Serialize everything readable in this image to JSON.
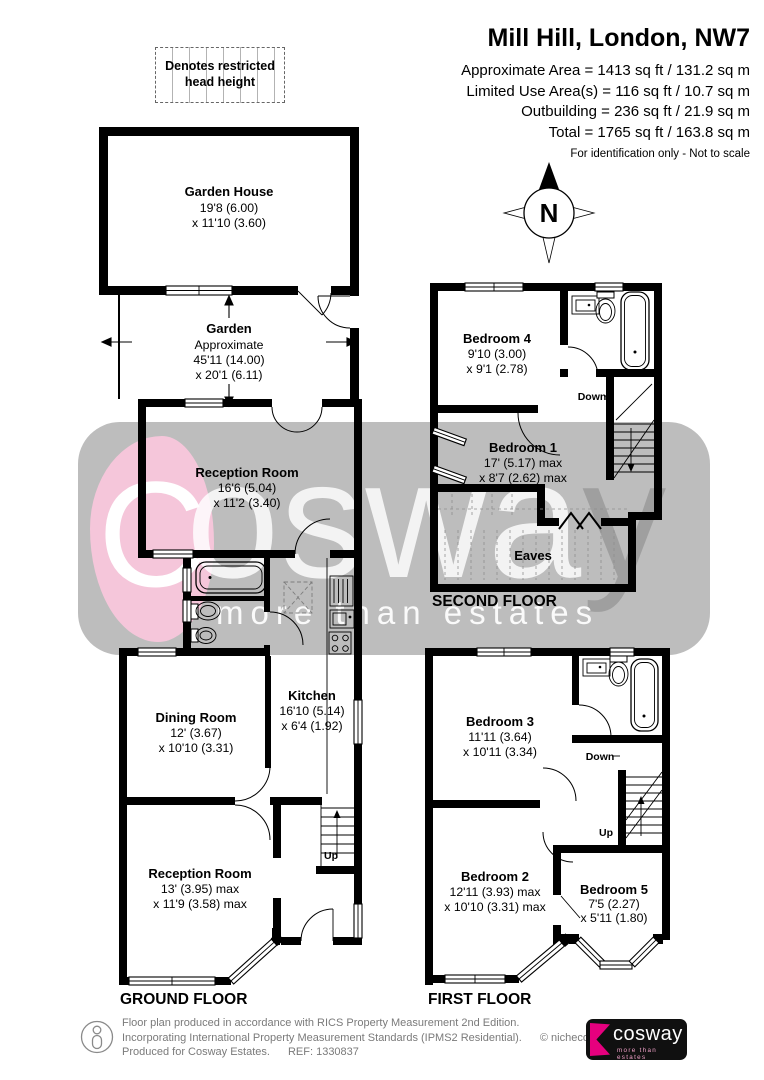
{
  "header": {
    "title": "Mill Hill, London, NW7",
    "line1": "Approximate Area = 1413 sq ft / 131.2 sq m",
    "line2": "Limited Use Area(s) = 116 sq ft / 10.7 sq m",
    "line3": "Outbuilding = 236 sq ft / 21.9 sq m",
    "line4": "Total = 1765 sq ft / 163.8 sq m",
    "disclaimer": "For identification only - Not to scale"
  },
  "legend": {
    "text": "Denotes restricted head height"
  },
  "compass": {
    "north": "N"
  },
  "watermark": {
    "initial": "C",
    "word_rest": "oswa",
    "word_last": "y",
    "tagline": "more than estates"
  },
  "floors": {
    "ground": {
      "label": "GROUND FLOOR",
      "stairs_up": "Up",
      "garden_house": {
        "name": "Garden House",
        "dim1": "19'8 (6.00)",
        "dim2": "x 11'10 (3.60)"
      },
      "garden": {
        "name": "Garden",
        "note": "Approximate",
        "dim1": "45'11 (14.00)",
        "dim2": "x 20'1 (6.11)"
      },
      "reception1": {
        "name": "Reception Room",
        "dim1": "16'6 (5.04)",
        "dim2": "x 11'2 (3.40)"
      },
      "kitchen": {
        "name": "Kitchen",
        "dim1": "16'10 (5.14)",
        "dim2": "x 6'4 (1.92)"
      },
      "dining": {
        "name": "Dining Room",
        "dim1": "12' (3.67)",
        "dim2": "x 10'10 (3.31)"
      },
      "reception2": {
        "name": "Reception Room",
        "dim1": "13' (3.95) max",
        "dim2": "x 11'9 (3.58) max"
      }
    },
    "second": {
      "label": "SECOND FLOOR",
      "stairs_down": "Down",
      "bedroom4": {
        "name": "Bedroom 4",
        "dim1": "9'10 (3.00)",
        "dim2": "x 9'1 (2.78)"
      },
      "bedroom1": {
        "name": "Bedroom 1",
        "dim1": "17' (5.17) max",
        "dim2": "x 8'7 (2.62) max"
      },
      "eaves": {
        "name": "Eaves"
      }
    },
    "first": {
      "label": "FIRST FLOOR",
      "stairs_down": "Down",
      "stairs_up": "Up",
      "bedroom3": {
        "name": "Bedroom 3",
        "dim1": "11'11 (3.64)",
        "dim2": "x 10'11 (3.34)"
      },
      "bedroom2": {
        "name": "Bedroom 2",
        "dim1": "12'11 (3.93) max",
        "dim2": "x 10'10 (3.31) max"
      },
      "bedroom5": {
        "name": "Bedroom 5",
        "dim1": "7'5 (2.27)",
        "dim2": "x 5'11 (1.80)"
      }
    }
  },
  "footer": {
    "line1": "Floor plan produced in accordance with RICS Property Measurement 2nd Edition.",
    "line2": "Incorporating International Property Measurement Standards (IPMS2 Residential).",
    "copyright": "© nichecom 2025.",
    "line3": "Produced for Cosway Estates.",
    "ref": "REF: 1330837",
    "logo_brand": "cosway",
    "logo_tagline": "more than estates"
  },
  "colors": {
    "wall": "#000000",
    "watermark_band": "#bdbdbd",
    "watermark_pink": "#f5c6da",
    "brand_pink": "#e6007e"
  }
}
